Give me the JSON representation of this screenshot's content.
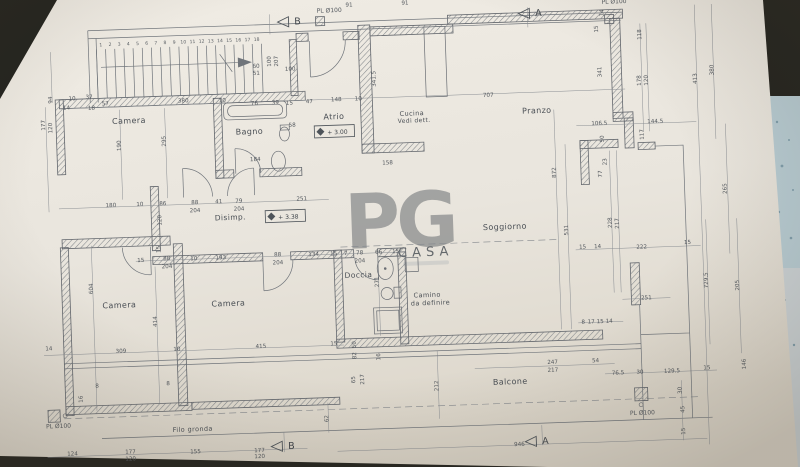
{
  "photo": {
    "surface_dark": "#24241f",
    "surface_stone_blue": "#b8ccd3",
    "surface_stone_light": "#ccd3d6",
    "paper_color": "#eae6de"
  },
  "watermark": {
    "logo": "PG",
    "brand": "CASA",
    "color": "#74bf44"
  },
  "elevations": [
    {
      "t": "+ 3.00"
    },
    {
      "t": "+ 3.38"
    }
  ],
  "rooms": [
    {
      "t": "Camera",
      "x": 133,
      "y": 114,
      "fs": 8
    },
    {
      "t": "Bagno",
      "x": 253,
      "y": 129,
      "fs": 8
    },
    {
      "t": "Atrio",
      "x": 338,
      "y": 117,
      "fs": 8
    },
    {
      "t": "Cucina",
      "x": 416,
      "y": 116,
      "fs": 6.5
    },
    {
      "t": "Vedi dett.",
      "x": 418,
      "y": 123,
      "fs": 6
    },
    {
      "t": "Pranzo",
      "x": 541,
      "y": 118,
      "fs": 8
    },
    {
      "t": "Disimp.",
      "x": 231,
      "y": 214,
      "fs": 7.5
    },
    {
      "t": "Soggiorno",
      "x": 505,
      "y": 233,
      "fs": 8
    },
    {
      "t": "Doccia",
      "x": 357,
      "y": 276,
      "fs": 7.5
    },
    {
      "t": "Camino",
      "x": 425,
      "y": 298,
      "fs": 6.5
    },
    {
      "t": "da definire",
      "x": 428,
      "y": 306,
      "fs": 6.5
    },
    {
      "t": "Camera",
      "x": 117,
      "y": 298,
      "fs": 8
    },
    {
      "t": "Camera",
      "x": 226,
      "y": 300,
      "fs": 8
    },
    {
      "t": "Balcone",
      "x": 505,
      "y": 388,
      "fs": 8
    },
    {
      "t": "Filo gronda",
      "x": 186,
      "y": 424,
      "fs": 6.5
    }
  ],
  "pl_labels": [
    {
      "t": "PL Ø100",
      "x": 337,
      "y": 10
    },
    {
      "t": "PL Ø100",
      "x": 622,
      "y": 11
    },
    {
      "t": "PL Ø100",
      "x": 52,
      "y": 416
    },
    {
      "t": "PL Ø100",
      "x": 636,
      "y": 423
    }
  ],
  "section_markers": [
    {
      "t": "B",
      "x": 305,
      "y": 21
    },
    {
      "t": "A",
      "x": 546,
      "y": 21
    },
    {
      "t": "B",
      "x": 284,
      "y": 445
    },
    {
      "t": "A",
      "x": 538,
      "y": 449
    }
  ],
  "stairs": {
    "numbers": [
      "1",
      "2",
      "3",
      "4",
      "5",
      "6",
      "7",
      "8",
      "9",
      "10",
      "11",
      "12",
      "13",
      "14",
      "15",
      "16",
      "17",
      "18"
    ]
  },
  "dims": [
    {
      "t": "91",
      "x": 357,
      "y": 5
    },
    {
      "t": "91",
      "x": 413,
      "y": 5
    },
    {
      "t": "10",
      "x": 77,
      "y": 89
    },
    {
      "t": "37",
      "x": 94,
      "y": 88
    },
    {
      "t": "14",
      "x": 71,
      "y": 98
    },
    {
      "t": "18",
      "x": 96,
      "y": 99
    },
    {
      "t": "57",
      "x": 110,
      "y": 95
    },
    {
      "t": "380",
      "x": 188,
      "y": 95
    },
    {
      "t": "10",
      "x": 227,
      "y": 96
    },
    {
      "t": "76",
      "x": 259,
      "y": 100
    },
    {
      "t": "39",
      "x": 280,
      "y": 100
    },
    {
      "t": "15",
      "x": 294,
      "y": 101
    },
    {
      "t": "47",
      "x": 314,
      "y": 100
    },
    {
      "t": "148",
      "x": 341,
      "y": 99
    },
    {
      "t": "10",
      "x": 363,
      "y": 99
    },
    {
      "t": "707",
      "x": 493,
      "y": 100
    },
    {
      "t": "94",
      "x": 57,
      "y": 88,
      "r": 1
    },
    {
      "t": "60",
      "x": 262,
      "y": 63
    },
    {
      "t": "51",
      "x": 262,
      "y": 70
    },
    {
      "t": "100",
      "x": 296,
      "y": 67
    },
    {
      "t": "100",
      "x": 277,
      "y": 57,
      "r": 1
    },
    {
      "t": "207",
      "x": 284,
      "y": 57,
      "r": 1
    },
    {
      "t": "184",
      "x": 258,
      "y": 156
    },
    {
      "t": "58",
      "x": 296,
      "y": 123
    },
    {
      "t": "341.5",
      "x": 381,
      "y": 78,
      "r": 1
    },
    {
      "t": "158",
      "x": 390,
      "y": 164
    },
    {
      "t": "295",
      "x": 169,
      "y": 133,
      "r": 1
    },
    {
      "t": "190",
      "x": 124,
      "y": 136,
      "r": 1
    },
    {
      "t": "177",
      "x": 49,
      "y": 113,
      "r": 1
    },
    {
      "t": "120",
      "x": 56,
      "y": 116,
      "r": 1
    },
    {
      "t": "14",
      "x": 611,
      "y": 20,
      "r": 1
    },
    {
      "t": "15",
      "x": 605,
      "y": 36,
      "r": 1
    },
    {
      "t": "118",
      "x": 648,
      "y": 43,
      "r": 1
    },
    {
      "t": "341",
      "x": 607,
      "y": 79,
      "r": 1
    },
    {
      "t": "178",
      "x": 646,
      "y": 89,
      "r": 1
    },
    {
      "t": "120",
      "x": 653,
      "y": 89,
      "r": 1
    },
    {
      "t": "413",
      "x": 702,
      "y": 89,
      "r": 1
    },
    {
      "t": "380",
      "x": 719,
      "y": 81,
      "r": 1
    },
    {
      "t": "106.5",
      "x": 603,
      "y": 132
    },
    {
      "t": "144.5",
      "x": 659,
      "y": 132
    },
    {
      "t": "117",
      "x": 647,
      "y": 143,
      "r": 1
    },
    {
      "t": "50",
      "x": 607,
      "y": 146,
      "r": 1
    },
    {
      "t": "23",
      "x": 609,
      "y": 169,
      "r": 1
    },
    {
      "t": "77",
      "x": 604,
      "y": 181,
      "r": 1
    },
    {
      "t": "872",
      "x": 558,
      "y": 178,
      "r": 1
    },
    {
      "t": "531",
      "x": 568,
      "y": 236,
      "r": 1
    },
    {
      "t": "228",
      "x": 612,
      "y": 230,
      "r": 1
    },
    {
      "t": "217",
      "x": 619,
      "y": 231,
      "r": 1
    },
    {
      "t": "265",
      "x": 728,
      "y": 200,
      "r": 1
    },
    {
      "t": "15",
      "x": 582,
      "y": 255
    },
    {
      "t": "14",
      "x": 597,
      "y": 255
    },
    {
      "t": "222",
      "x": 641,
      "y": 257
    },
    {
      "t": "15",
      "x": 687,
      "y": 254
    },
    {
      "t": "729.5",
      "x": 706,
      "y": 291,
      "r": 1
    },
    {
      "t": "205",
      "x": 737,
      "y": 297,
      "r": 1
    },
    {
      "t": "146",
      "x": 741,
      "y": 376,
      "r": 1
    },
    {
      "t": "251",
      "x": 644,
      "y": 308
    },
    {
      "t": "8",
      "x": 580,
      "y": 330
    },
    {
      "t": "17",
      "x": 588,
      "y": 330
    },
    {
      "t": "15",
      "x": 597,
      "y": 330
    },
    {
      "t": "14",
      "x": 606,
      "y": 330
    },
    {
      "t": "180",
      "x": 112,
      "y": 197
    },
    {
      "t": "10",
      "x": 141,
      "y": 197
    },
    {
      "t": "86",
      "x": 164,
      "y": 197
    },
    {
      "t": "88",
      "x": 196,
      "y": 197
    },
    {
      "t": "204",
      "x": 196,
      "y": 205
    },
    {
      "t": "41",
      "x": 220,
      "y": 197
    },
    {
      "t": "79",
      "x": 240,
      "y": 197
    },
    {
      "t": "204",
      "x": 240,
      "y": 205
    },
    {
      "t": "251",
      "x": 303,
      "y": 197
    },
    {
      "t": "120",
      "x": 162,
      "y": 212,
      "r": 1
    },
    {
      "t": "15",
      "x": 160,
      "y": 241,
      "r": 1
    },
    {
      "t": "15",
      "x": 140,
      "y": 253
    },
    {
      "t": "88",
      "x": 166,
      "y": 252
    },
    {
      "t": "204",
      "x": 166,
      "y": 260
    },
    {
      "t": "10",
      "x": 193,
      "y": 253
    },
    {
      "t": "193",
      "x": 220,
      "y": 253
    },
    {
      "t": "88",
      "x": 277,
      "y": 252
    },
    {
      "t": "204",
      "x": 277,
      "y": 260
    },
    {
      "t": "134",
      "x": 313,
      "y": 253
    },
    {
      "t": "15",
      "x": 333,
      "y": 253
    },
    {
      "t": "7",
      "x": 345,
      "y": 253
    },
    {
      "t": "78",
      "x": 359,
      "y": 253
    },
    {
      "t": "204",
      "x": 359,
      "y": 261
    },
    {
      "t": "66",
      "x": 378,
      "y": 253
    },
    {
      "t": "15",
      "x": 395,
      "y": 253
    },
    {
      "t": "271",
      "x": 377,
      "y": 281,
      "r": 1
    },
    {
      "t": "604",
      "x": 91,
      "y": 278,
      "r": 1
    },
    {
      "t": "414",
      "x": 154,
      "y": 313,
      "r": 1
    },
    {
      "t": "14",
      "x": 45,
      "y": 338
    },
    {
      "t": "309",
      "x": 117,
      "y": 343
    },
    {
      "t": "10",
      "x": 173,
      "y": 343
    },
    {
      "t": "415",
      "x": 257,
      "y": 343
    },
    {
      "t": "15",
      "x": 330,
      "y": 343
    },
    {
      "t": "8",
      "x": 92,
      "y": 377
    },
    {
      "t": "8",
      "x": 163,
      "y": 377
    },
    {
      "t": "16",
      "x": 77,
      "y": 388,
      "r": 1
    },
    {
      "t": "50",
      "x": 352,
      "y": 343,
      "r": 1
    },
    {
      "t": "82",
      "x": 352,
      "y": 354,
      "r": 1
    },
    {
      "t": "16",
      "x": 376,
      "y": 356,
      "r": 1
    },
    {
      "t": "65",
      "x": 350,
      "y": 378,
      "r": 1
    },
    {
      "t": "217",
      "x": 359,
      "y": 378,
      "r": 1
    },
    {
      "t": "247",
      "x": 548,
      "y": 369
    },
    {
      "t": "217",
      "x": 548,
      "y": 377
    },
    {
      "t": "54",
      "x": 591,
      "y": 369
    },
    {
      "t": "76.5",
      "x": 613,
      "y": 382
    },
    {
      "t": "30",
      "x": 635,
      "y": 382
    },
    {
      "t": "129.5",
      "x": 667,
      "y": 382
    },
    {
      "t": "15",
      "x": 702,
      "y": 380
    },
    {
      "t": "212",
      "x": 433,
      "y": 387,
      "r": 1
    },
    {
      "t": "62",
      "x": 322,
      "y": 416,
      "r": 1
    },
    {
      "t": "30",
      "x": 676,
      "y": 400,
      "r": 1
    },
    {
      "t": "45",
      "x": 678,
      "y": 419,
      "r": 1
    },
    {
      "t": "15",
      "x": 678,
      "y": 441,
      "r": 1
    },
    {
      "t": "124",
      "x": 65,
      "y": 444
    },
    {
      "t": "177",
      "x": 123,
      "y": 444
    },
    {
      "t": "120",
      "x": 123,
      "y": 451
    },
    {
      "t": "155",
      "x": 188,
      "y": 446
    },
    {
      "t": "177",
      "x": 252,
      "y": 447
    },
    {
      "t": "120",
      "x": 252,
      "y": 453
    },
    {
      "t": "946",
      "x": 512,
      "y": 450
    }
  ]
}
